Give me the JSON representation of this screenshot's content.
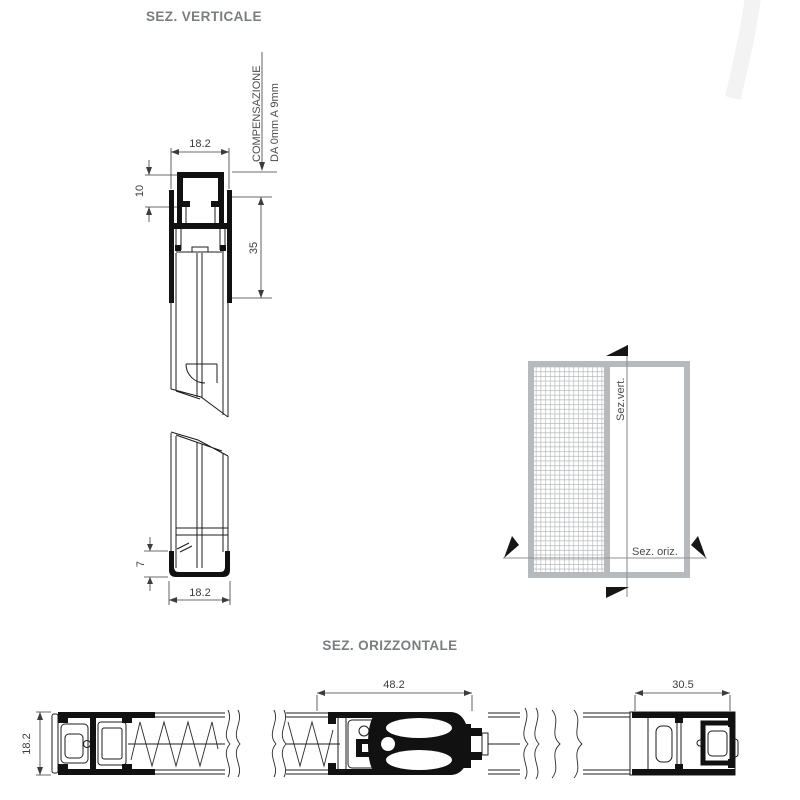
{
  "drawing": {
    "vertical_section": {
      "title": "SEZ. VERTICALE",
      "compensation_label_line1": "COMPENSAZIONE",
      "compensation_label_line2": "DA 0mm A 9mm",
      "dim_track_width_top": "18.2",
      "dim_channel_height": "10",
      "dim_track_height": "35",
      "dim_bottom_channel_height": "7",
      "dim_bottom_channel_width": "18.2"
    },
    "horizontal_section": {
      "title": "SEZ. ORIZZONTALE",
      "dim_left_profile_depth": "18.2",
      "dim_center_profile_width": "48.2",
      "dim_right_profile_width": "30.5"
    },
    "schematic": {
      "vertical_cut_label": "Sez.vert.",
      "horizontal_cut_label": "Sez. oriz."
    },
    "colors": {
      "line": "#1c1c1c",
      "dim_text": "#3a3c3e",
      "title_text": "#7a7d80",
      "schematic_gray": "#b7babc",
      "mesh_line": "#b4b7b9",
      "watermark": "#f3f3f4"
    }
  }
}
